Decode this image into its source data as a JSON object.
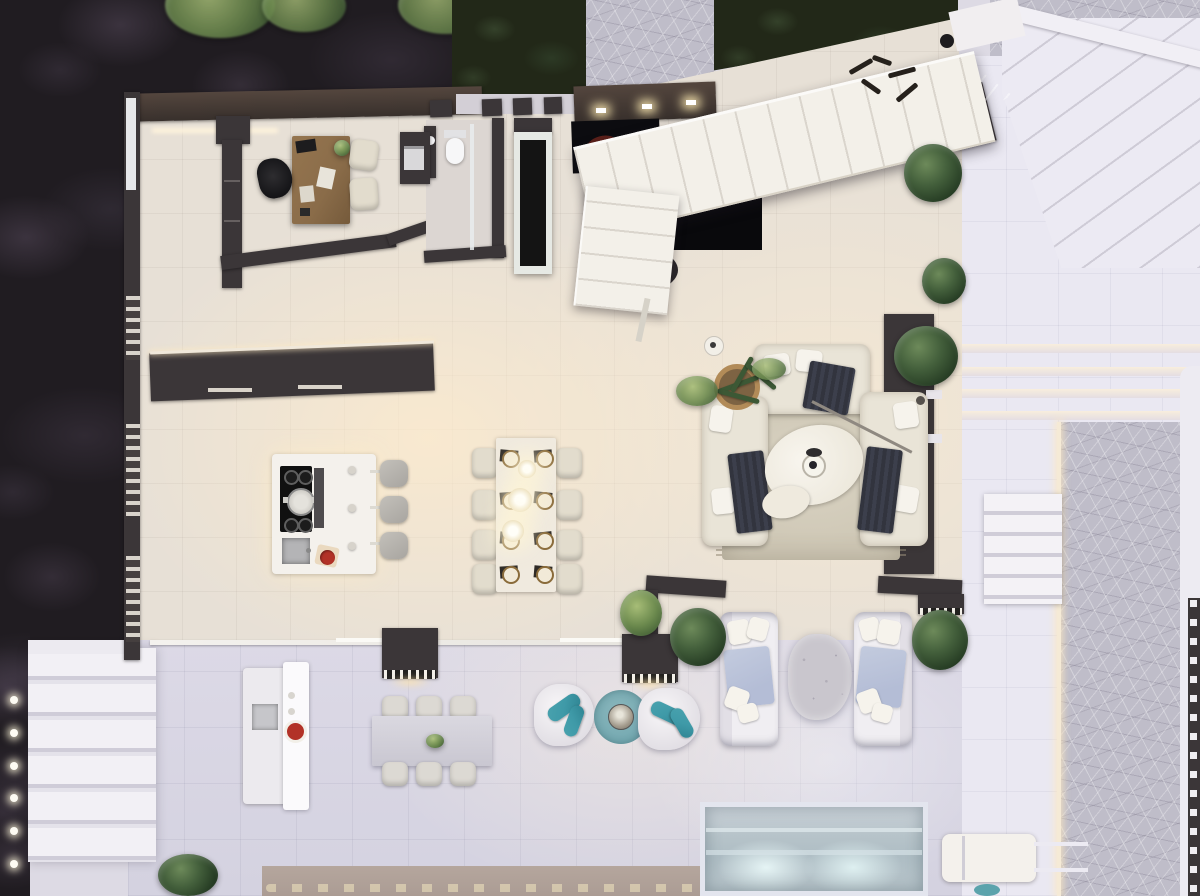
{
  "scene": {
    "type": "architectural-floor-plan-3d-render",
    "view": "top-down orthographic",
    "lighting": "dusk with warm interior lights",
    "canvas": {
      "width": 1200,
      "height": 896
    },
    "text_visible": "none"
  },
  "palette": {
    "garden_dark": "#201c21",
    "hedge_green": "#222818",
    "tree_green": "#6f855c",
    "flagstone": "#bfbdc9",
    "terrace_tile": "#eae8f2",
    "outdoor_tile": "#dcd9e6",
    "indoor_floor": "#e7e0d6",
    "floor_glow": "#f8ecd4",
    "wall_dark": "#3b3638",
    "wall_brown": "#54463e",
    "stair_white": "#f3f0e9",
    "item_white": "#f4f1ec",
    "wood_desk": "#8a6c49",
    "sofa_cream": "#e9e4d7",
    "chair_cream": "#e2dccd",
    "throw_navy": "#32343e",
    "rug_beige": "#cfc8b6",
    "blanket_blue": "#b4bdd6",
    "stone_table_grey": "#c9c6cd",
    "teal_accent": "#3f9aa8",
    "teal_rug": "#74a9b1",
    "pool_water": "#aebdc4",
    "tan_deck": "#b5a69d",
    "tomato_red": "#b23227",
    "lamp_glow": "#ffeec7",
    "plant_green": "#44603c"
  },
  "areas": [
    {
      "id": "garden",
      "label": "Garden strip (top and left edges)",
      "items": [
        "dark lawn with purple-tinted shrub texture",
        "3 tree canopies along top edge",
        "small pale flowering shrub"
      ]
    },
    {
      "id": "entry_walkway",
      "label": "Front entry walkway",
      "items": [
        "flagstone path between hedges",
        "entry wall with 3 lit pillars",
        "pillar beams over side path"
      ]
    },
    {
      "id": "home_office",
      "label": "Home office (top left)",
      "items": [
        "wooden desk",
        "black desk chair",
        "2 cream guest chairs",
        "laptop",
        "papers",
        "small desk plant",
        "side cabinet with printer",
        "ceiling light strip"
      ]
    },
    {
      "id": "bathroom",
      "label": "Guest bathroom",
      "items": [
        "toilet",
        "dark vanity with basin",
        "glass partition"
      ]
    },
    {
      "id": "foyer_stairs",
      "label": "Foyer and staircase",
      "items": [
        "white L-shaped staircase with treads",
        "dark landing mat",
        "dark red floor cushion",
        "double-sided fireplace column",
        "metal wall-art squiggles",
        "floor pot",
        "dark fan steps to side terrace",
        "corner bar wall"
      ]
    },
    {
      "id": "kitchen",
      "label": "Kitchen",
      "items": [
        "full-wall dark cabinet run with lit counter edge",
        "white island",
        "induction cooktop with pot",
        "downdraft hood strip",
        "inset sink",
        "cutting board with tomatoes",
        "3 grey bar stools",
        "left wall louvre vents"
      ]
    },
    {
      "id": "dining",
      "label": "Dining area",
      "items": [
        "cream table for 8",
        "8 cream chairs",
        "8 place settings with gold-rim plates and dark mats",
        "3 glowing pendant lamps"
      ]
    },
    {
      "id": "living",
      "label": "Living room",
      "items": [
        "3 cream sofas in U layout",
        "3 dark striped throws",
        "6 white cushions",
        "oval stone coffee table with black bowl",
        "small nesting table",
        "arc floor lamp",
        "beige fringed rug",
        "palm in wicker basket planter",
        "small vase",
        "media wall with white ledges",
        "3 shrubs along right wall"
      ]
    },
    {
      "id": "terrace_lounge",
      "label": "Covered terrace lounge",
      "items": [
        "2 white outdoor sofas with light-blue blankets",
        "organic speckled stone coffee table",
        "2 white organic lounge chairs",
        "4 teal bolster pillows",
        "round teal rug",
        "round metal side table",
        "2 dark bar consoles with bottle rows",
        "glass slider track",
        "potted shrubs"
      ]
    },
    {
      "id": "terrace_dining",
      "label": "Terrace dining and outdoor kitchen",
      "items": [
        "grey table for 6",
        "6 chairs",
        "white outdoor kitchen island",
        "outdoor sink",
        "plate of tomatoes",
        "green sprig centerpiece"
      ]
    },
    {
      "id": "pool_area",
      "label": "Pool edge (bottom)",
      "items": [
        "pool with underwater lights and ledge steps",
        "white sun lounger with rails",
        "teal ball",
        "tan deck band with ornamental edge"
      ]
    },
    {
      "id": "exterior_right",
      "label": "Right side terraces and paths",
      "items": [
        "white tile terrace",
        "4 wide warm-lit steps",
        "diagonal corner steps",
        "flagstone driveway path",
        "white step walkway",
        "pergola strip with white planters",
        "white parapet band"
      ]
    },
    {
      "id": "exterior_left",
      "label": "Left garden steps",
      "items": [
        "6 wide white steps",
        "6 path lights",
        "louvred wall vents",
        "bottom-edge plant"
      ]
    }
  ]
}
